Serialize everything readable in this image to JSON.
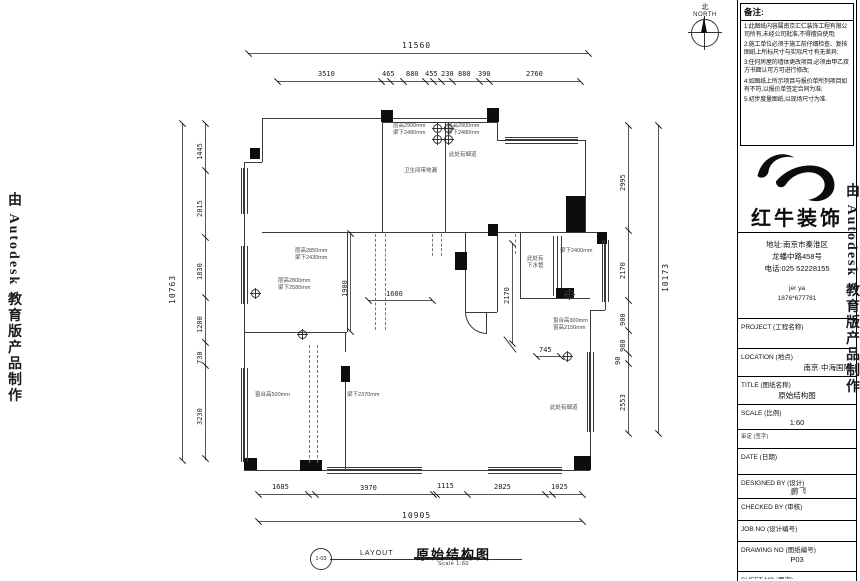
{
  "watermark": {
    "left": "由 Autodesk 教育版产品制作",
    "right": "由 Autodesk 教育版产品制作"
  },
  "north": {
    "label_cn": "北",
    "label_en": "NORTH"
  },
  "notes": {
    "title": "备注:",
    "items": [
      "1:此图纸内容属南京汇仁装饰工程有限公司所有,未经公司批准,不得擅自使用;",
      "2:施工单位必须于施工前仔细检查、复核图纸上所标尺寸与实际尺寸有无差异;",
      "3:任何房屋的墙体更改项目,必须由甲乙双方书面认可方可进行修改;",
      "4:如图纸上所示项目与报价单所列项目如有不符,以报价单签定合同为准;",
      "5:初步度量图纸,以现场尺寸为准."
    ]
  },
  "brand": {
    "name": "红牛装饰",
    "address_line1": "地址:南京市秦淮区",
    "address_line2": "龙蟠中路458号",
    "phone": "电话:025 52228155",
    "contact_name": "jer ya",
    "contact_phone": "1876*677781"
  },
  "titleblock": {
    "rows": [
      {
        "label": "PROJECT (工程名称)",
        "value": ""
      },
      {
        "label": "LOCATION (地点)",
        "value": "南京·中海国际"
      },
      {
        "label": "TITLE (图纸名称)",
        "value": "原始结构图"
      },
      {
        "label": "SCALE (比例)",
        "value": "1:60"
      },
      {
        "label": "审定 (签字)",
        "value": ""
      },
      {
        "label": "DATE (日期)",
        "value": ""
      },
      {
        "label": "DESIGNED BY (设计)",
        "value": "鹏飞"
      },
      {
        "label": "CHECKED BY (审核)",
        "value": ""
      },
      {
        "label": "JOB   NO (设计编号)",
        "value": ""
      },
      {
        "label": "DRAWING NO (图纸编号)",
        "value": "P03"
      },
      {
        "label": "SHEET NO (页次)",
        "value": ""
      }
    ]
  },
  "footer": {
    "callout": "1-03",
    "layout_label": "LAYOUT",
    "title": "原始结构图",
    "scale": "Scale 1:60"
  },
  "plan": {
    "dimensions": [
      {
        "o": "h",
        "y": 53,
        "x1": 248,
        "x2": 588,
        "ticks": [
          248,
          588
        ],
        "labels": [
          {
            "t": "11560",
            "x": 402,
            "y": 41,
            "big": true
          }
        ]
      },
      {
        "o": "h",
        "y": 81,
        "x1": 277,
        "x2": 580,
        "ticks": [
          277,
          381,
          390,
          403,
          425,
          433,
          441,
          452,
          479,
          489,
          580
        ],
        "labels": [
          {
            "t": "3510",
            "x": 318,
            "y": 70
          },
          {
            "t": "465",
            "x": 382,
            "y": 70
          },
          {
            "t": "880",
            "x": 406,
            "y": 70
          },
          {
            "t": "455",
            "x": 425,
            "y": 70
          },
          {
            "t": "230",
            "x": 441,
            "y": 70
          },
          {
            "t": "880",
            "x": 458,
            "y": 70
          },
          {
            "t": "390",
            "x": 478,
            "y": 70
          },
          {
            "t": "2760",
            "x": 526,
            "y": 70
          }
        ]
      },
      {
        "o": "v",
        "x": 182,
        "y1": 123,
        "y2": 460,
        "ticks": [
          123,
          460
        ],
        "labels": [
          {
            "t": "10763",
            "x": 168,
            "y": 304,
            "rot": true,
            "big": true
          }
        ]
      },
      {
        "o": "v",
        "x": 205,
        "y1": 123,
        "y2": 460,
        "ticks": [
          123,
          170,
          237,
          297,
          342,
          365,
          458
        ],
        "labels": [
          {
            "t": "1445",
            "x": 196,
            "y": 160,
            "rot": true
          },
          {
            "t": "2015",
            "x": 196,
            "y": 217,
            "rot": true
          },
          {
            "t": "1830",
            "x": 196,
            "y": 280,
            "rot": true
          },
          {
            "t": "1200",
            "x": 196,
            "y": 333,
            "rot": true
          },
          {
            "t": "730",
            "x": 196,
            "y": 364,
            "rot": true
          },
          {
            "t": "3230",
            "x": 196,
            "y": 425,
            "rot": true
          }
        ]
      },
      {
        "o": "v",
        "x": 628,
        "y1": 125,
        "y2": 433,
        "ticks": [
          125,
          230,
          300,
          330,
          353,
          363,
          433
        ],
        "labels": [
          {
            "t": "2995",
            "x": 619,
            "y": 191,
            "rot": true
          },
          {
            "t": "2170",
            "x": 619,
            "y": 279,
            "rot": true
          },
          {
            "t": "900",
            "x": 619,
            "y": 326,
            "rot": true
          },
          {
            "t": "980",
            "x": 619,
            "y": 352,
            "rot": true
          },
          {
            "t": "90",
            "x": 614,
            "y": 365,
            "rot": true
          },
          {
            "t": "2553",
            "x": 619,
            "y": 411,
            "rot": true
          }
        ]
      },
      {
        "o": "v",
        "x": 658,
        "y1": 125,
        "y2": 433,
        "ticks": [
          125,
          433
        ],
        "labels": [
          {
            "t": "10173",
            "x": 661,
            "y": 292,
            "rot": true,
            "big": true
          }
        ]
      },
      {
        "o": "h",
        "y": 494,
        "x1": 258,
        "x2": 582,
        "ticks": [
          258,
          308,
          315,
          433,
          436,
          467,
          545,
          552,
          582
        ],
        "labels": [
          {
            "t": "1685",
            "x": 272,
            "y": 483
          },
          {
            "t": "3970",
            "x": 360,
            "y": 484
          },
          {
            "t": "1115",
            "x": 437,
            "y": 482
          },
          {
            "t": "2825",
            "x": 494,
            "y": 483
          },
          {
            "t": "1025",
            "x": 551,
            "y": 483
          }
        ]
      },
      {
        "o": "h",
        "y": 521,
        "x1": 258,
        "x2": 582,
        "ticks": [
          258,
          582
        ],
        "labels": [
          {
            "t": "10905",
            "x": 402,
            "y": 511,
            "big": true
          }
        ]
      },
      {
        "o": "v",
        "x": 350,
        "y1": 233,
        "y2": 331,
        "ticks": [
          233,
          331
        ],
        "labels": [
          {
            "t": "1900",
            "x": 341,
            "y": 297,
            "rot": true
          }
        ]
      },
      {
        "o": "h",
        "y": 300,
        "x1": 368,
        "x2": 432,
        "ticks": [
          368,
          432
        ],
        "labels": [
          {
            "t": "1600",
            "x": 386,
            "y": 290
          }
        ]
      },
      {
        "o": "h",
        "y": 356,
        "x1": 536,
        "x2": 560,
        "ticks": [
          536,
          560
        ],
        "labels": [
          {
            "t": "745",
            "x": 539,
            "y": 346
          }
        ]
      },
      {
        "o": "v",
        "x": 512,
        "y1": 243,
        "y2": 343,
        "ticks": [
          243,
          343
        ],
        "labels": [
          {
            "t": "2170",
            "x": 503,
            "y": 304,
            "rot": true
          }
        ]
      }
    ],
    "annotations": [
      {
        "x": 278,
        "y": 278,
        "lines": [
          "层高2800mm",
          "梁下2580mm"
        ]
      },
      {
        "x": 393,
        "y": 123,
        "lines": [
          "层高2900mm",
          "梁下2480mm"
        ]
      },
      {
        "x": 447,
        "y": 123,
        "lines": [
          "层高2900mm",
          "梁下2480mm"
        ]
      },
      {
        "x": 404,
        "y": 168,
        "lines": [
          "卫生间带地漏"
        ]
      },
      {
        "x": 449,
        "y": 152,
        "lines": [
          "此处有烟道"
        ]
      },
      {
        "x": 295,
        "y": 248,
        "lines": [
          "层高2850mm",
          "梁下2430mm"
        ]
      },
      {
        "x": 347,
        "y": 392,
        "lines": [
          "梁下2370mm"
        ]
      },
      {
        "x": 527,
        "y": 256,
        "lines": [
          "此处有",
          "下水管"
        ]
      },
      {
        "x": 553,
        "y": 318,
        "lines": [
          "窗台高300mm",
          "窗高2150mm"
        ]
      },
      {
        "x": 560,
        "y": 248,
        "lines": [
          "梁下2400mm"
        ]
      },
      {
        "x": 255,
        "y": 392,
        "lines": [
          "窗台高500mm"
        ]
      },
      {
        "x": 550,
        "y": 405,
        "lines": [
          "此处有烟道"
        ]
      }
    ],
    "symbols": [
      {
        "x": 433,
        "y": 124
      },
      {
        "x": 444,
        "y": 124
      },
      {
        "x": 433,
        "y": 135
      },
      {
        "x": 444,
        "y": 135
      },
      {
        "x": 251,
        "y": 289
      },
      {
        "x": 298,
        "y": 330
      },
      {
        "x": 565,
        "y": 290
      },
      {
        "x": 563,
        "y": 352
      }
    ]
  }
}
